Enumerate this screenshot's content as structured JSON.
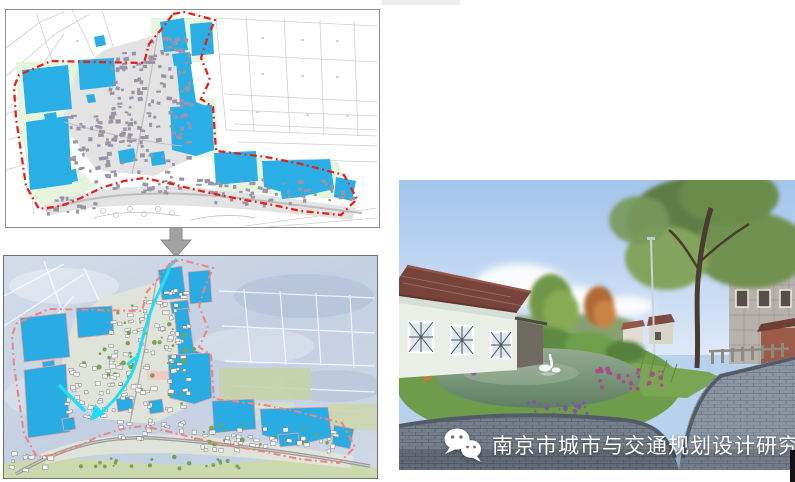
{
  "figure": {
    "panels": {
      "before_map": {
        "alt": "cadastral base map with blue ponds and red dash-dot village boundary"
      },
      "after_map": {
        "alt": "rendered water-system plan with blue ponds, cyan channels and pink boundary"
      },
      "rendering_photo": {
        "alt": "landscape rendering of restored village pond with swan, flowers, houses and paved lane"
      }
    },
    "transform_arrow": {
      "direction": "down",
      "color": "#A2A2A2"
    },
    "colors": {
      "pond_blue": "#29AFE6",
      "boundary_red": "#E4211B",
      "boundary_pink": "#F2837C",
      "channel_cyan": "#1FDEF5",
      "farmland_green": "#E8F5DE",
      "building_gray": "#9B94A6",
      "sky_blue": "#A3C4EC",
      "watermark_white": "#FFFFFF"
    },
    "watermark": {
      "icon": "wechat-logo",
      "text": "南京市城市与交通规划设计研究院"
    }
  }
}
